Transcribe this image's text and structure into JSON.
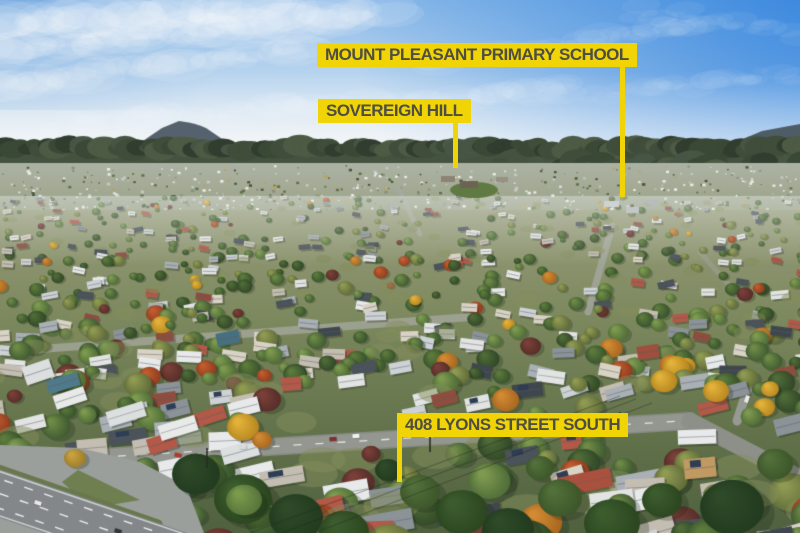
{
  "annotations": {
    "school": {
      "label": "MOUNT PLEASANT PRIMARY SCHOOL"
    },
    "sovereign_hill": {
      "label": "SOVEREIGN HILL"
    },
    "property": {
      "label": "408 LYONS STREET SOUTH"
    }
  },
  "colors": {
    "label_bg": "#F0D405",
    "label_text": "#4E4E42"
  }
}
